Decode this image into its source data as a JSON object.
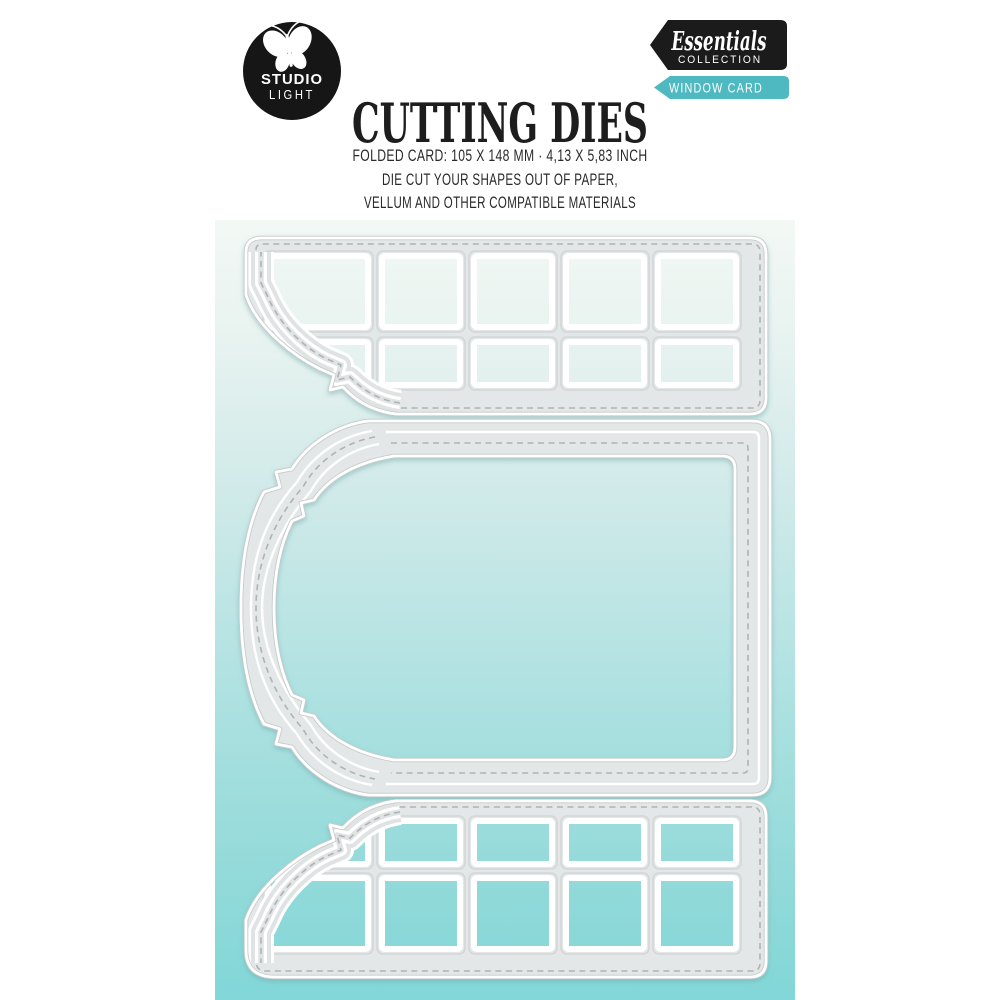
{
  "page": {
    "background": "#ffffff"
  },
  "brand": {
    "logo_line1": "STUDIO",
    "logo_line2": "LIGHT",
    "logo_bg": "#161616",
    "logo_icon": "butterfly-icon"
  },
  "badges": {
    "collection": {
      "script": "Essentials",
      "caps": "COLLECTION",
      "bg": "#1b1b1b",
      "fg": "#ffffff"
    },
    "product": {
      "label": "WINDOW CARD",
      "bg": "#4fb9c1",
      "fg": "#ffffff"
    }
  },
  "header": {
    "title": "CUTTING DIES",
    "spec_line": "FOLDED CARD: 105 X 148 MM · 4,13 X 5,83 INCH",
    "description_line1": "DIE CUT YOUR SHAPES OUT OF PAPER,",
    "description_line2": "VELLUM AND OTHER COMPATIBLE MATERIALS"
  },
  "artwork": {
    "panel_gradient_top": "#f3f8f5",
    "panel_gradient_bottom": "#82d7d8",
    "die_color": "#e4e7e7",
    "die_edge_color": "#ffffff",
    "stitch_color": "#aeb4b4",
    "pieces": [
      {
        "name": "top window grid die",
        "windows_columns": 5,
        "windows_rows": 2
      },
      {
        "name": "folded card frame die with ornate bracket edge",
        "windows_columns": 0,
        "windows_rows": 0
      },
      {
        "name": "bottom window grid die",
        "windows_columns": 5,
        "windows_rows": 2
      }
    ]
  }
}
